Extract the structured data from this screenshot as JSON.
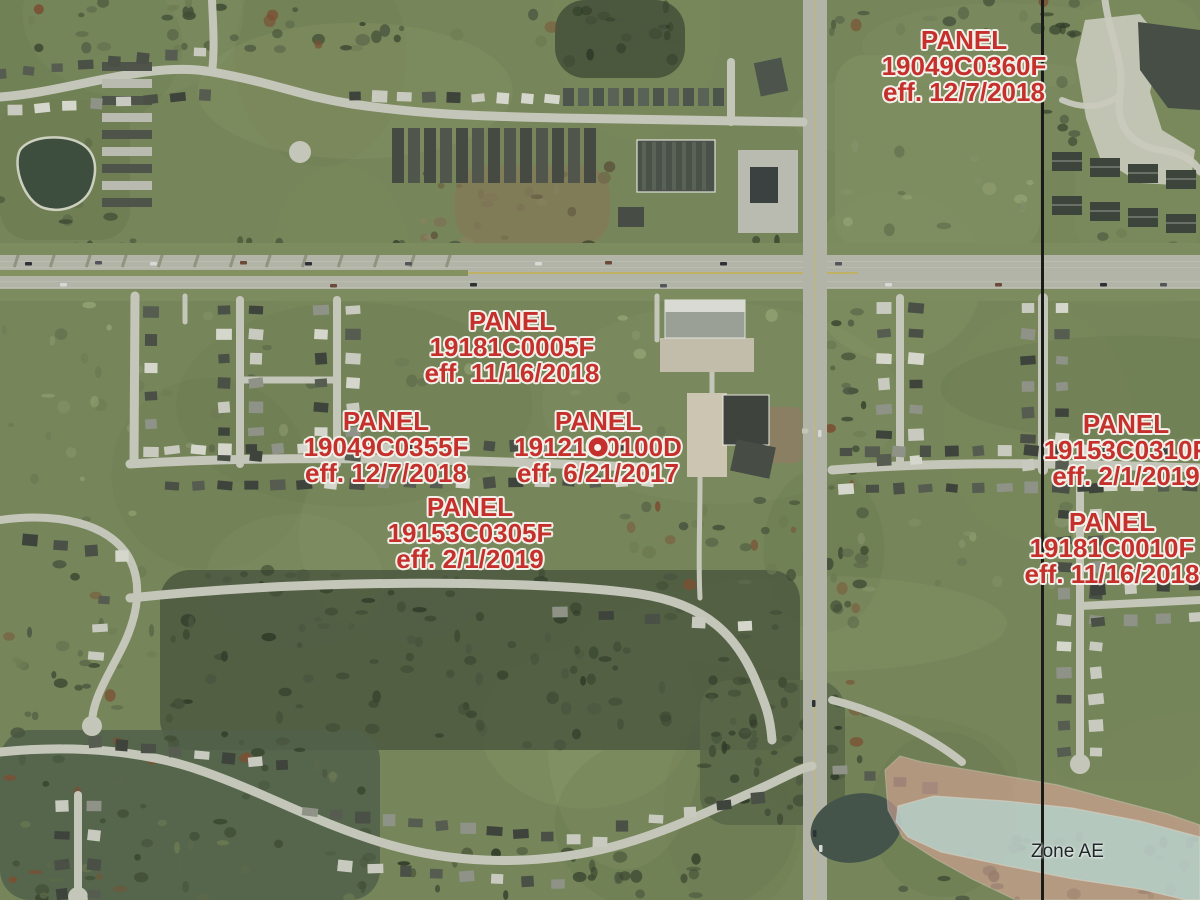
{
  "map": {
    "kind": "FEMA flood-hazard panel index over aerial imagery",
    "panel_labels": [
      {
        "word": "PANEL",
        "number": "19049C0360F",
        "effective": "eff. 12/7/2018",
        "x": 964,
        "y": 27,
        "marker": false
      },
      {
        "word": "PANEL",
        "number": "19181C0005F",
        "effective": "eff. 11/16/2018",
        "x": 512,
        "y": 308,
        "marker": false
      },
      {
        "word": "PANEL",
        "number": "19049C0355F",
        "effective": "eff. 12/7/2018",
        "x": 386,
        "y": 408,
        "marker": false
      },
      {
        "word": "PANEL",
        "number": "19121C0100D",
        "effective": "eff. 6/21/2017",
        "x": 598,
        "y": 408,
        "marker": true
      },
      {
        "word": "PANEL",
        "number": "19153C0310F",
        "effective": "eff. 2/1/2019",
        "x": 1126,
        "y": 411,
        "marker": false
      },
      {
        "word": "PANEL",
        "number": "19153C0305F",
        "effective": "eff. 2/1/2019",
        "x": 470,
        "y": 494,
        "marker": false
      },
      {
        "word": "PANEL",
        "number": "19181C0010F",
        "effective": "eff. 11/16/2018",
        "x": 1112,
        "y": 509,
        "marker": false
      }
    ],
    "flood_zone_label": {
      "text": "Zone AE",
      "x": 1031,
      "y": 841
    },
    "panel_boundary_line": {
      "x": 1041
    },
    "colors": {
      "label_red": "#c5302c",
      "label_halo": "#f2f0e8",
      "zone_text": "#20272a",
      "boundary_line": "#1b1c19",
      "flood_zone_ae_fill": "#b7dad6",
      "flood_zone_fringe_fill": "#dca89b"
    }
  }
}
